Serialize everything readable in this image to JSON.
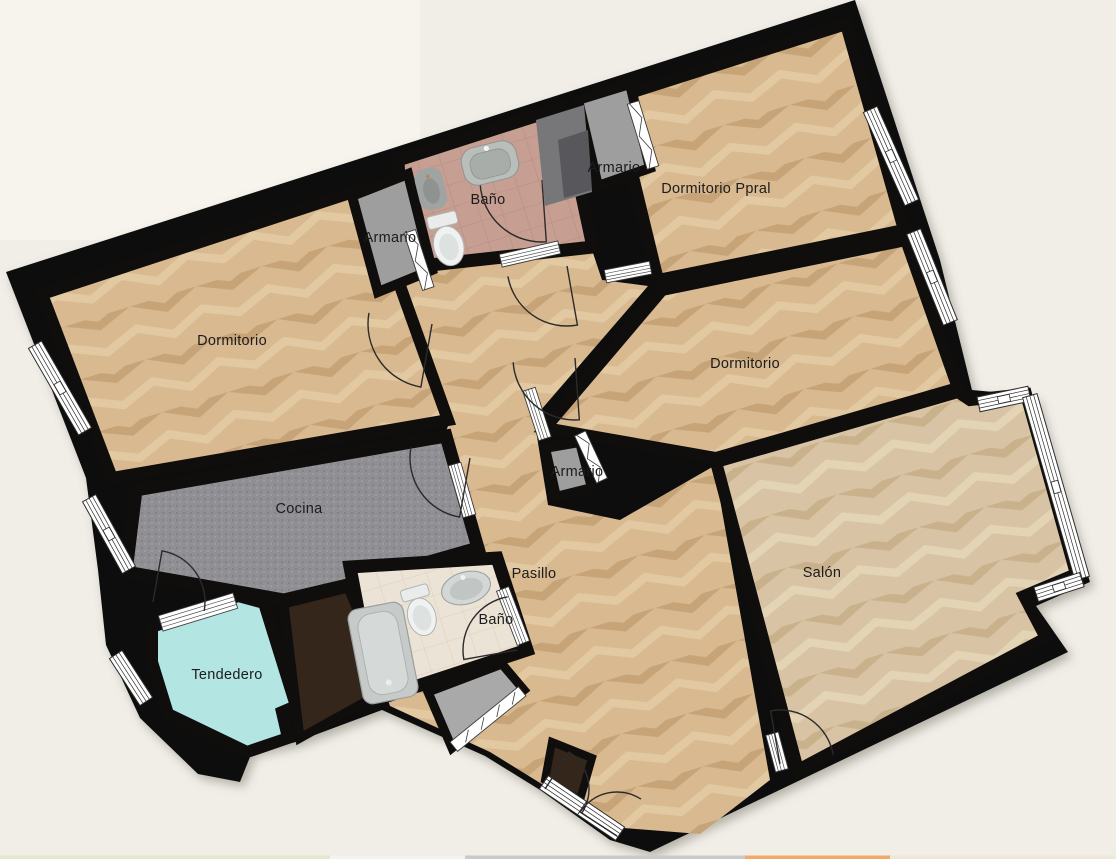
{
  "floorplan": {
    "rooms": {
      "bano_top": {
        "label": "Baño"
      },
      "armario_top_right": {
        "label": "Armario"
      },
      "dormitorio_ppral": {
        "label": "Dormitorio Ppral"
      },
      "armario_top_left": {
        "label": "Armario"
      },
      "dormitorio_left": {
        "label": "Dormitorio"
      },
      "dormitorio_mid": {
        "label": "Dormitorio"
      },
      "cocina": {
        "label": "Cocina"
      },
      "armario_center": {
        "label": "Armario"
      },
      "pasillo": {
        "label": "Pasillo"
      },
      "bano_bottom": {
        "label": "Baño"
      },
      "salon": {
        "label": "Salón"
      },
      "tendedero": {
        "label": "Tendedero"
      }
    },
    "colors": {
      "background": "#f0eee7",
      "background_light": "#f7f5ef",
      "wall": "#0f0e0c",
      "wood": "#d8b990",
      "wood_salon": "#d8c3a4",
      "kitchen_floor": "#8f8f94",
      "bath_top_floor": "#c79e92",
      "bath_bottom_floor": "#ebe3d5",
      "tendedero_floor": "#b3e5e3",
      "shaft": "#34261b",
      "closet_floor": "#a9a9a9",
      "armario_floor": "#9e9e9e",
      "fixture_light": "#d6dad7",
      "fixture_mid": "#b2b7b4",
      "cabinet_dark": "#6a6a6d"
    },
    "strip": {
      "s1": "#e4e8cf",
      "s2": "#f2f2ee",
      "s3": "#cacaca",
      "s4": "#f4a869",
      "s5": "#eee8d8"
    }
  }
}
